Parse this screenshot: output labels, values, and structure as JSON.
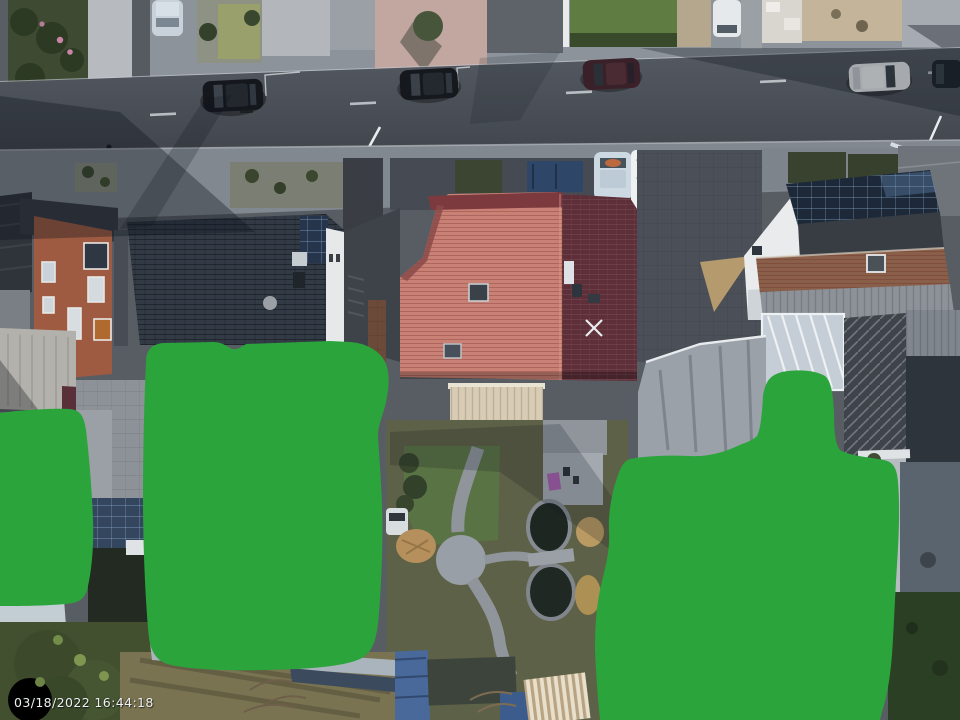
{
  "image": {
    "timestamp": "03/18/2022 16:44:18"
  },
  "colors": {
    "privacy_mask_green": "#2BA43C",
    "road_asphalt": "#4A4F57",
    "red_roof_sunlit": "#C98175",
    "red_roof_shaded": "#5E2F38",
    "dark_blue_roof": "#323A45",
    "brick_house": "#9E5B42",
    "lawn_green": "#5F7C42",
    "garage_cream": "#D8CDB4",
    "solar_panel": "#1D2938"
  },
  "objects": {
    "privacy_masks": [
      "privacy-mask-left",
      "privacy-mask-center",
      "privacy-mask-right"
    ],
    "street_vehicles": [
      "black-car-1",
      "black-car-2",
      "maroon-car",
      "white-car",
      "dark-car-edge"
    ],
    "parked_vehicles": [
      "silver-car-top",
      "white-van-top",
      "light-blue-car",
      "white-camper-van",
      "blue-dumpster"
    ]
  }
}
